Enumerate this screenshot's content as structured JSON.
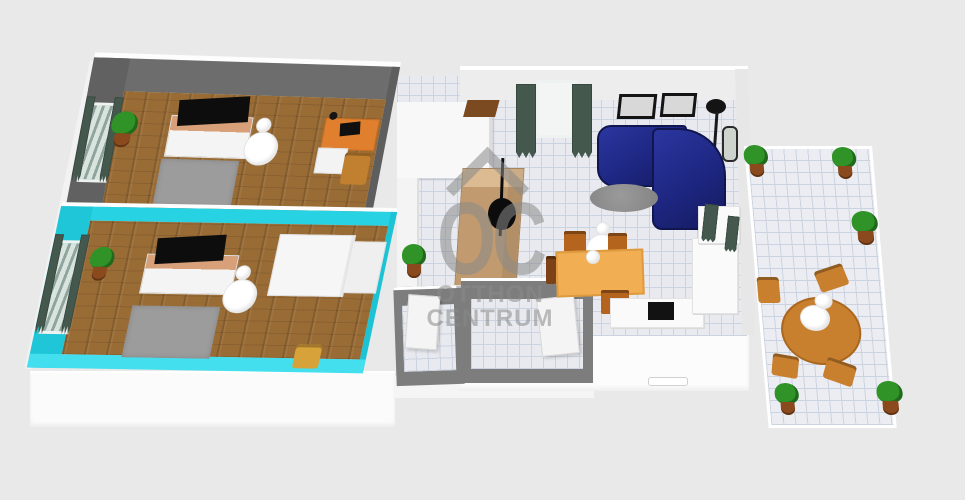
{
  "watermark": {
    "logo": "OC",
    "line1": "OTTHON",
    "line2": "CENTRUM"
  },
  "colors": {
    "bg": "#e9e9e9",
    "wall_dark": "#6d6d6d",
    "wall_dark_side": "#5e5e5e",
    "wall_cyan": "#27d3e3",
    "wall_cyan_side": "#1fc6d8",
    "wall_cyan_front": "#44dfee",
    "wall_gray": "#7d7d7d",
    "wall_white": "#ededed",
    "floor_wood": "#9a6c35",
    "tile": "#e9eaef",
    "tile_line": "#ccd3e0",
    "rug": "#9c9c9c",
    "tv": "#0d0d0d",
    "stand_top": "#d8a078",
    "lamp": "#ffffff",
    "plant_green": "#2f9328",
    "plant_pot": "#8b4a1d",
    "desk": "#e0802f",
    "wood_chair": "#c08030",
    "dining_chair": "#b5641d",
    "wardrobe_tan": "#c19a6f",
    "wardrobe_tan_top": "#dcba92",
    "coat_rack": "#0c0c0c",
    "sofa": "#1d2680",
    "sofa_dark": "#11164f",
    "coffee_table": "#8f8f8f",
    "dining_table": "#f2ae52",
    "curtain": "#44584e",
    "door_brown": "#7c4a21",
    "counter": "#fafafa",
    "stove": "#121212",
    "terrace_table": "#c8802f",
    "watermark": "#8a8a8a"
  }
}
